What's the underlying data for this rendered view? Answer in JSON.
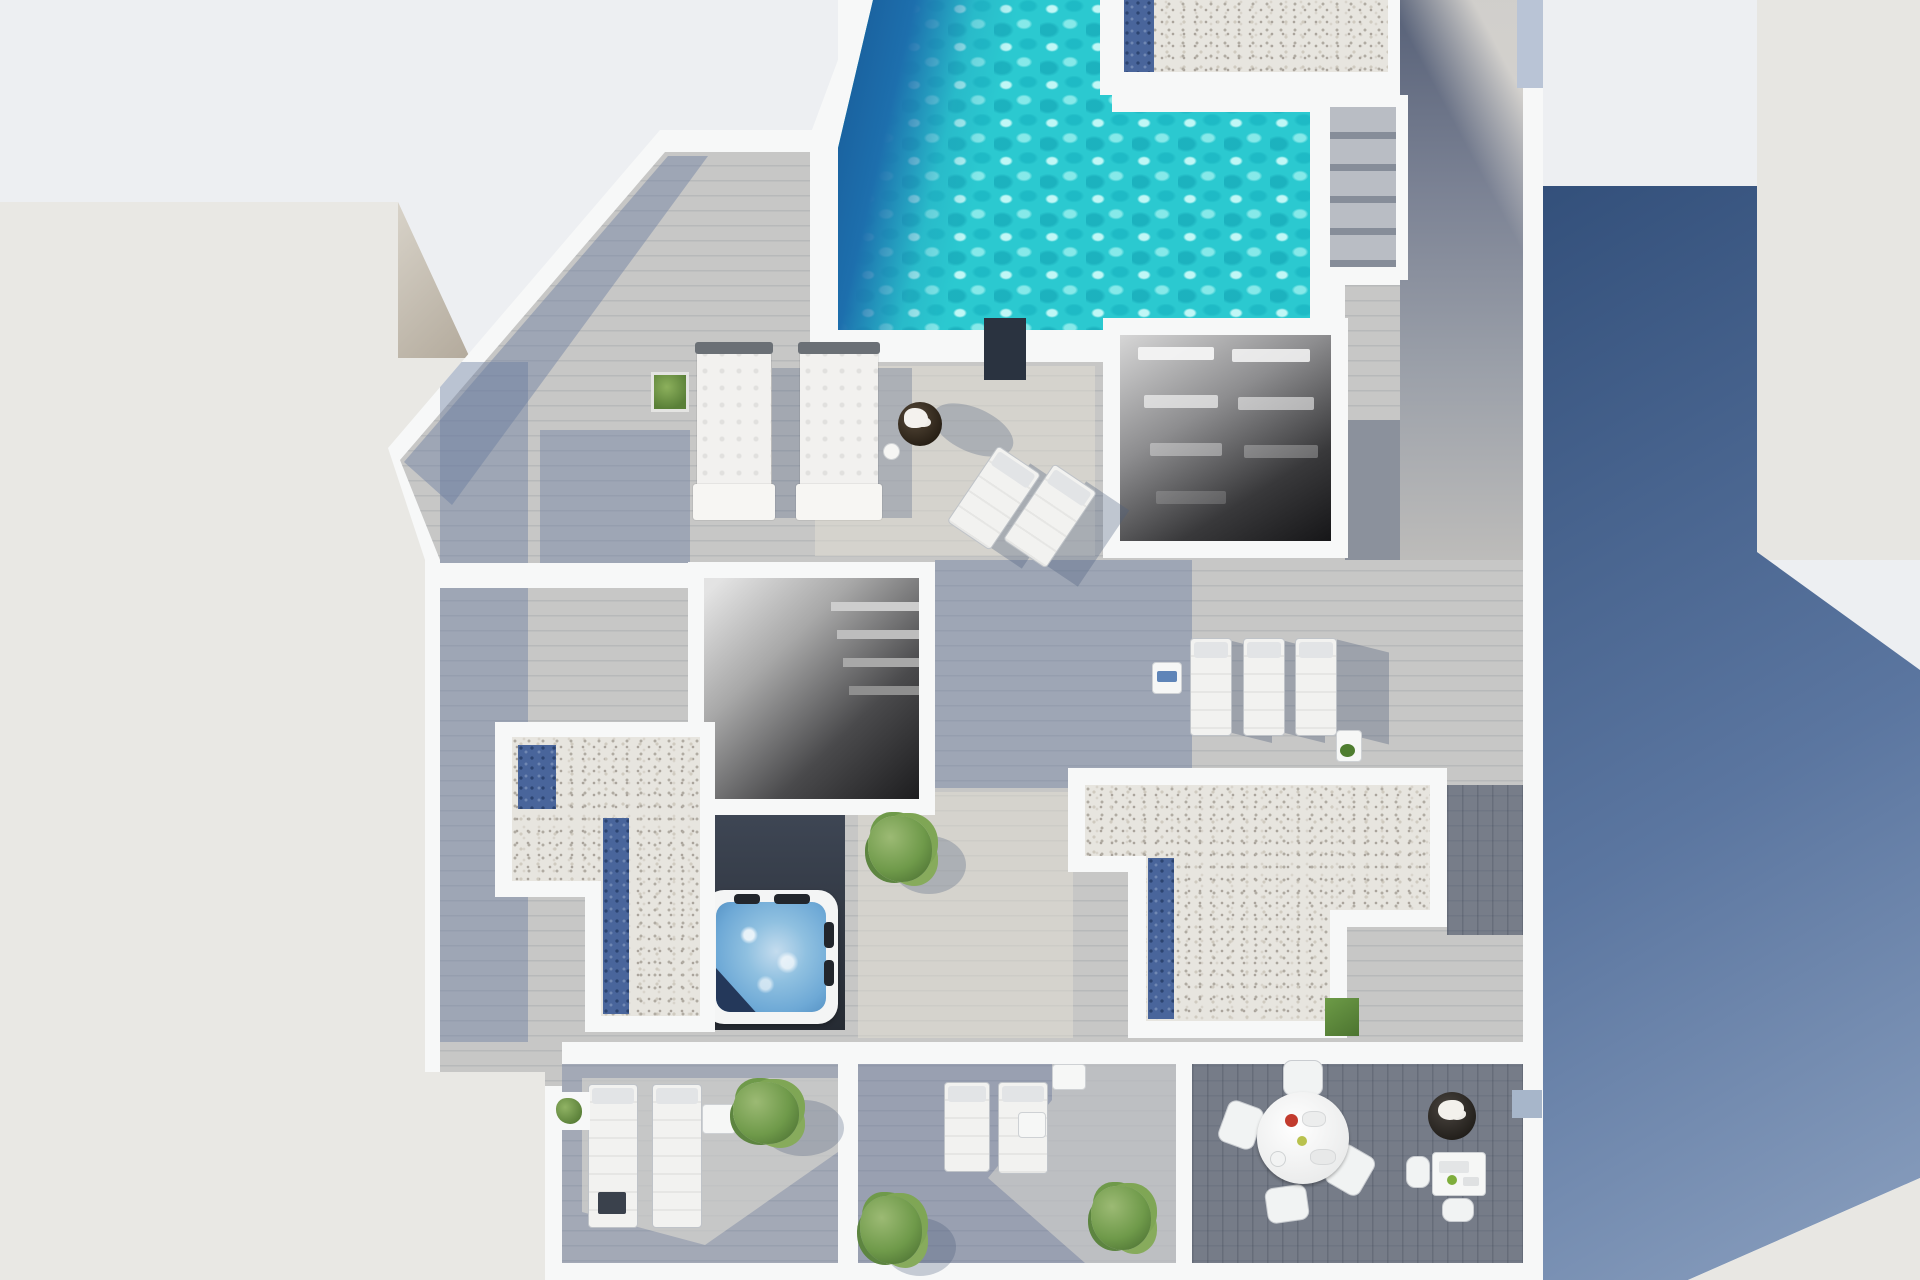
{
  "scene": {
    "description": "Photorealistic top-down 3D architectural rendering of a modern rooftop terrace / penthouse solarium floor plan",
    "view": "aerial top-down",
    "time_of_day": "sunny daylight with long blue shadows cast to the right"
  },
  "labels": {
    "swimming_pool": "L-shaped swimming pool with turquoise rippled water and dark deep end",
    "pool_deck": "Gray wood plank sun deck",
    "gravel_roof_top": "Gravel roof section with skylight strip beside pool",
    "gravel_roof_left": "L-shaped gravel roof section with glass skylight strips",
    "gravel_roof_center": "T-shaped gravel roof section with glass skylight strip",
    "skylight_strip": "Dark blue glass skylight strip",
    "pergola": "White louvered pergola roof over lower patio",
    "stairwell": "Open stairwell to lower floor with visible steps",
    "outdoor_stairs": "Outdoor wooden stairs from raised walkway to pool deck",
    "walkway": "Raised wooden walkway along right side",
    "jacuzzi": "Square hot tub with blue bubbling water and dark headrests",
    "daybeds": "Two white tufted double daybeds",
    "pool_loungers": "Row of three white sun loungers",
    "deck_chairs": "Two angled white lounge chairs",
    "dining_table": "Round white dining table with four chairs",
    "coffee_table": "White coffee table with seats and decor",
    "round_planter": "Dark round planter with white flowers",
    "plants": "Green potted plants and bushes",
    "grass_patch": "Small artificial grass square",
    "left_building": "Neighboring building roof, light gray",
    "right_building": "Neighboring building, sunlit facade",
    "shadow_region": "Large blue-gray cast shadow area",
    "dark_mat": "Dark lounger mat at pool edge",
    "towel_table": "Small side table with blue towel"
  },
  "object_counts": {
    "pools": 1,
    "jacuzzis": 1,
    "daybeds": 2,
    "sun_loungers": 7,
    "angled_deck_chairs": 2,
    "dining_chairs": 4,
    "tables": 6,
    "plants_and_bushes": 9,
    "skylight_strips": 4,
    "gravel_roof_sections": 3,
    "stair_openings": 2,
    "pergolas": 1
  },
  "theme": {
    "bg": "#edeff2",
    "wall_white": "#f7f8f8",
    "building_light": "#e9e8e4",
    "building_facet": "#c9c2b5",
    "building_right": "#e7e6e2",
    "shadow_blue_dark": "#33507b",
    "shadow_blue_light": "#8ba0bf",
    "pool_turquoise": "#2bc9d0",
    "pool_deep": "#1b5c9d",
    "gravel": "#e7e5df",
    "skylight": "#49659b",
    "deck_light": "#c7c7c6",
    "deck_warm": "#dedad2",
    "deck_dark": "#6e7788",
    "jacuzzi_water": "#6ea9d6",
    "plant_green": "#6f9a4a",
    "accent_red": "#c23b2e"
  }
}
